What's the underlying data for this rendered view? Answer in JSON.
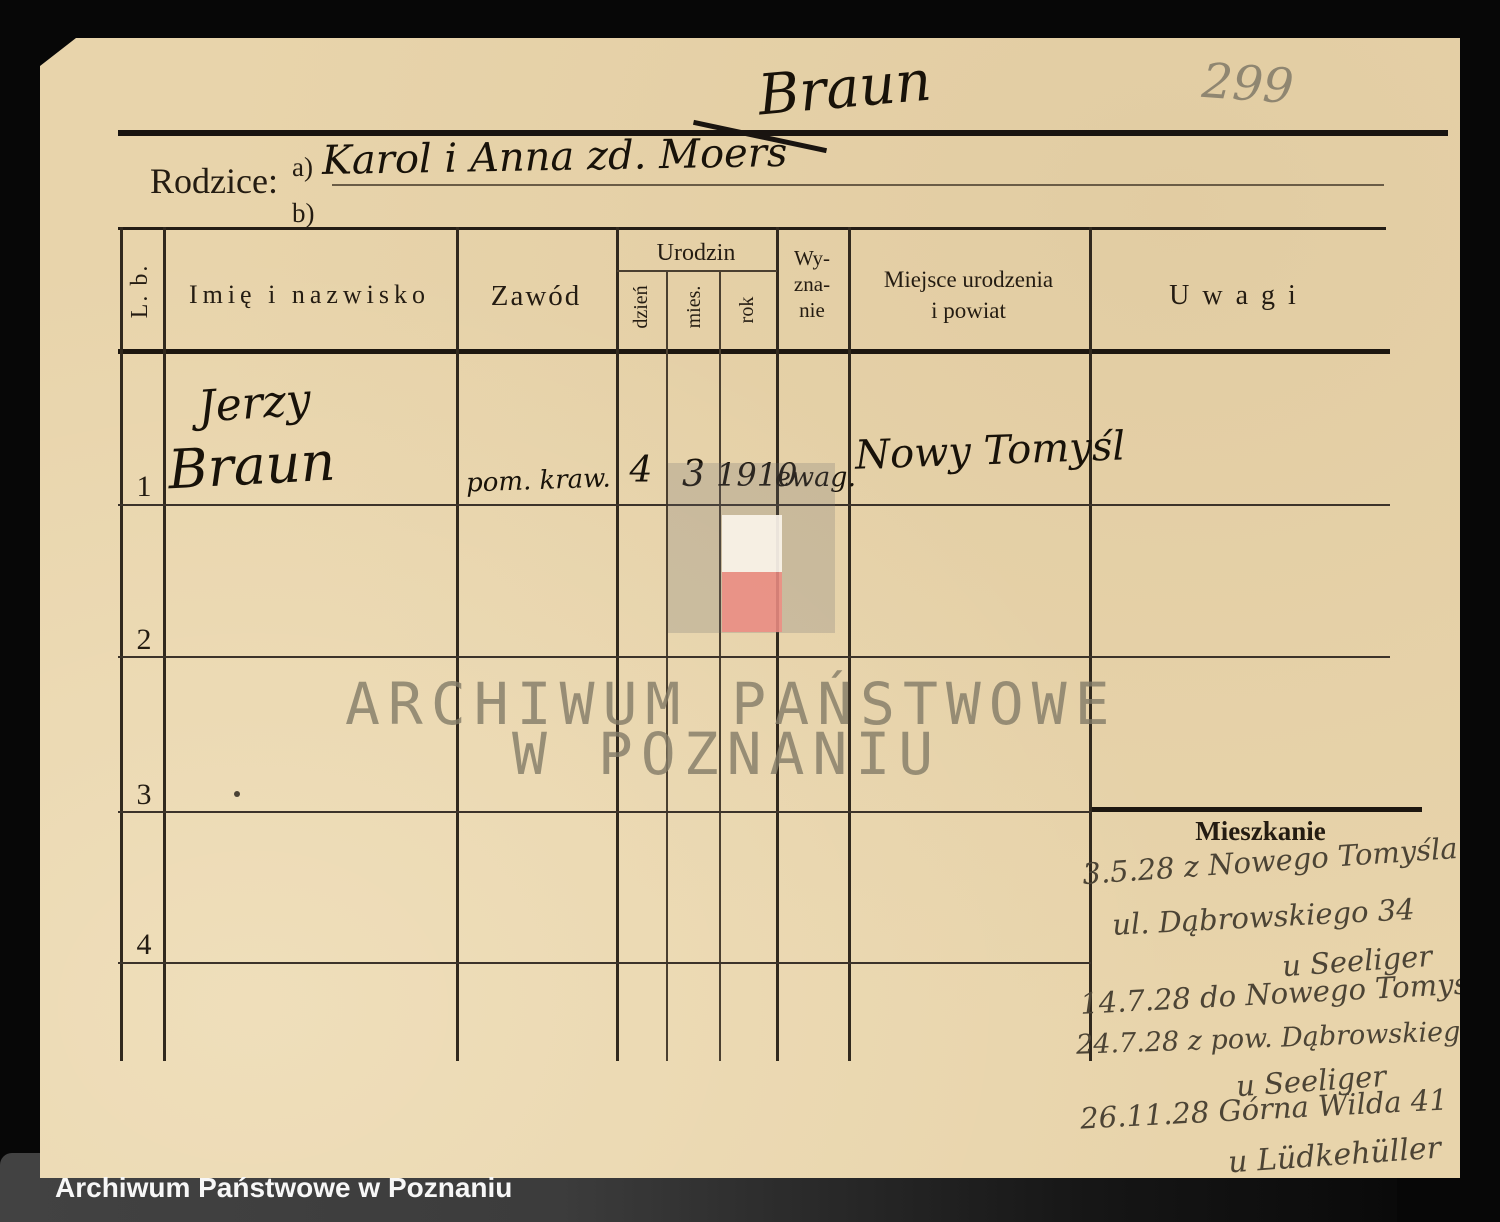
{
  "colors": {
    "paper": "#e8d4ab",
    "background": "#070707",
    "print_ink": "#241c12",
    "hand_ink": "#181209",
    "hand_ink_gray": "#4c4435",
    "pencil": "#8f8671",
    "watermark_text": "#82766a",
    "flag_white": "#f6efe3",
    "flag_red": "#f0a49b",
    "caption_bar": "#3c3c3c",
    "caption_text": "#f7f7f7"
  },
  "header": {
    "surname": "Braun",
    "page_number": "299",
    "rodzice_label": "Rodzice:",
    "line_a_label": "a)",
    "line_a_value": "Karol i Anna zd. Moers",
    "line_b_label": "b)",
    "line_b_value": ""
  },
  "table": {
    "col_lb": "L. b.",
    "col_name": "Imię i nazwisko",
    "col_zawod": "Zawód",
    "col_urodzin": "Urodzin",
    "col_dzien": "dzień",
    "col_mies": "mies.",
    "col_rok": "rok",
    "col_wyznanie_lines": [
      "Wy-",
      "zna-",
      "nie"
    ],
    "col_miejsce_lines": [
      "Miejsce urodzenia",
      "i powiat"
    ],
    "col_uwagi": "Uwagi",
    "rows": [
      {
        "lb": "1",
        "name_line1": "Jerzy",
        "name_line2": "Braun",
        "zawod": "pom. kraw.",
        "dzien": "4",
        "mies": "3",
        "rok": "1910",
        "wyznanie": "ewag.",
        "miejsce": "Nowy Tomyśl"
      },
      {
        "lb": "2",
        "name_line1": "",
        "name_line2": "",
        "zawod": "",
        "dzien": "",
        "mies": "",
        "rok": "",
        "wyznanie": "",
        "miejsce": ""
      },
      {
        "lb": "3",
        "name_line1": "",
        "name_line2": "",
        "zawod": "",
        "dzien": "",
        "mies": "",
        "rok": "",
        "wyznanie": "",
        "miejsce": ""
      },
      {
        "lb": "4",
        "name_line1": "",
        "name_line2": "",
        "zawod": "",
        "dzien": "",
        "mies": "",
        "rok": "",
        "wyznanie": "",
        "miejsce": ""
      }
    ]
  },
  "mieszkanie": {
    "label": "Mieszkanie",
    "entries": [
      "3.5.28 z Nowego Tomyśla",
      "ul. Dąbrowskiego 34",
      "u Seeliger",
      "14.7.28 do Nowego Tomyśla",
      "24.7.28 z pow. Dąbrowskiego 34",
      "u Seeliger",
      "26.11.28 Górna Wilda 41",
      "u Lüdkehüller"
    ]
  },
  "watermark": {
    "line1": "ARCHIWUM PAŃSTWOWE",
    "line2": "W POZNANIU"
  },
  "caption": "Archiwum Państwowe w Poznaniu"
}
